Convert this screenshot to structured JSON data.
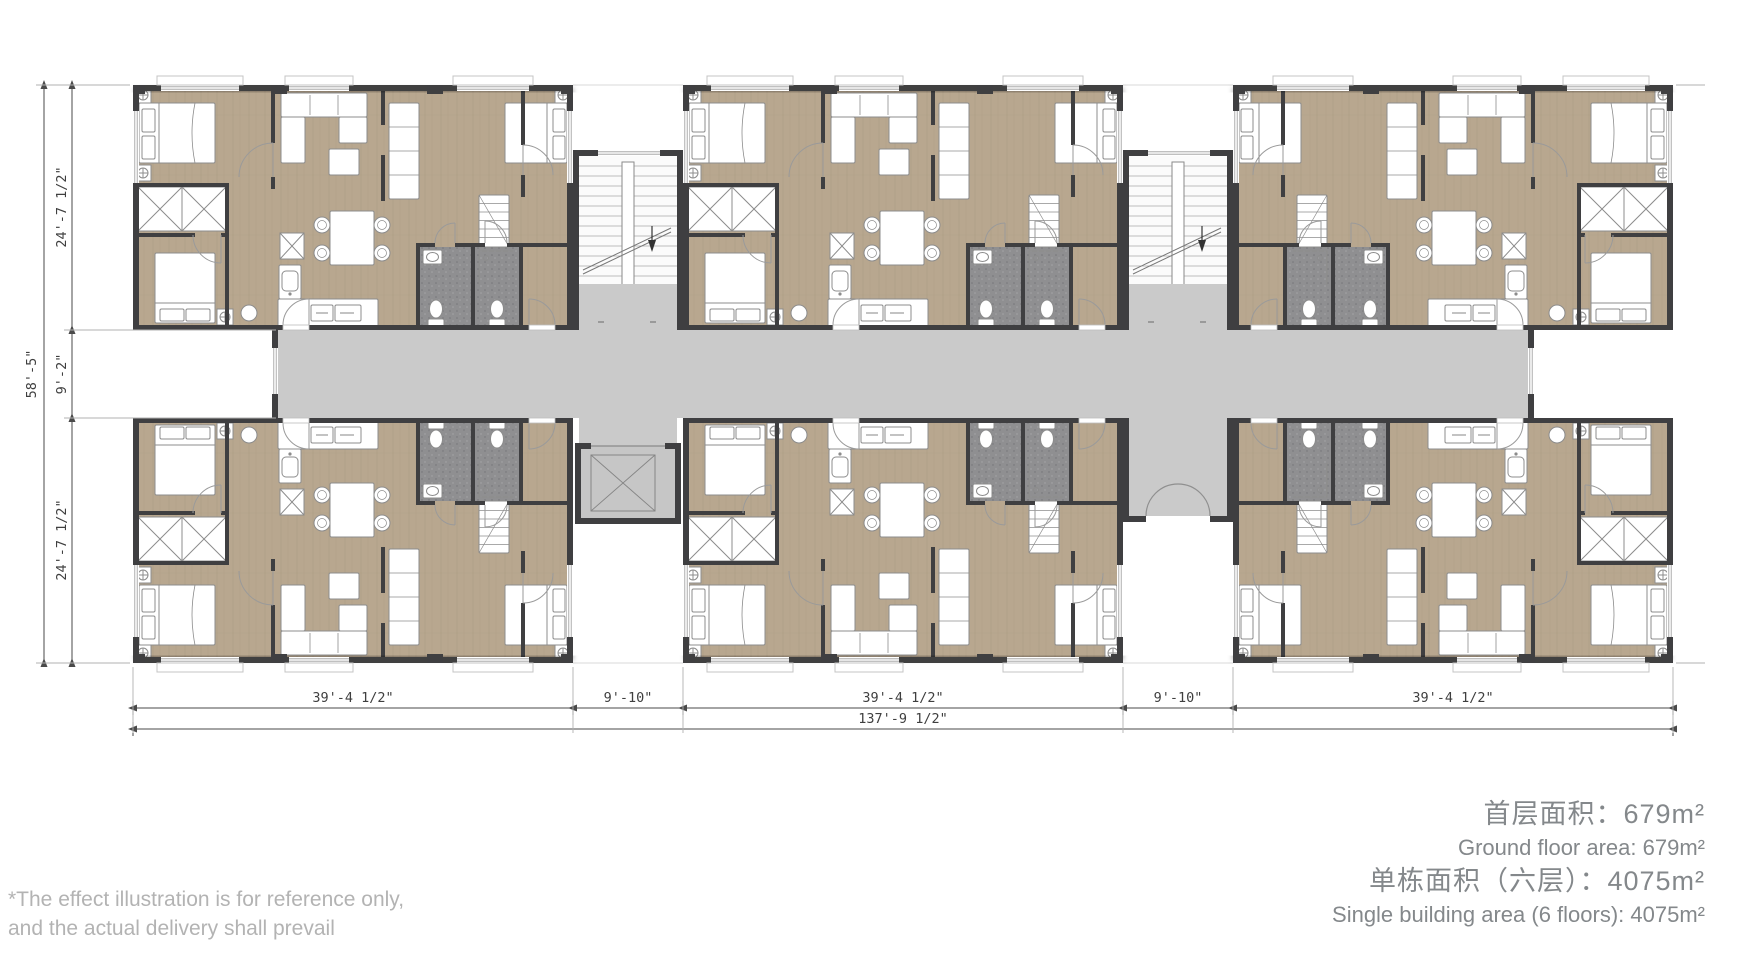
{
  "title": "residential-floor-plan",
  "colors": {
    "wall": "#3f3f41",
    "floor_tan": "#b8a78f",
    "floor_grain": "#9d8c74",
    "corridor_gray": "#cacaca",
    "bathroom_gray": "#8f8f91",
    "furniture_line": "#8c8c8c",
    "dimension_line": "#4a4a4a",
    "extension_line": "#b0b0b0",
    "annotation_gray": "#84888b",
    "disclaimer_gray": "#b3b3b3"
  },
  "dimensions": {
    "left": {
      "overall": "58'-5\"",
      "segments": [
        "24'-7 1/2\"",
        "9'-2\"",
        "24'-7 1/2\""
      ]
    },
    "bottom": {
      "segments": [
        "39'-4 1/2\"",
        "9'-10\"",
        "39'-4 1/2\"",
        "9'-10\"",
        "39'-4 1/2\""
      ],
      "overall": "137'-9 1/2\""
    }
  },
  "area_info": {
    "floor_area_zh": "首层面积：679m²",
    "floor_area_en": "Ground floor area: 679m²",
    "building_area_zh": "单栋面积（六层）：4075m²",
    "building_area_en": "Single building area (6 floors): 4075m²"
  },
  "disclaimer": {
    "line1": "*The effect illustration is for reference only,",
    "line2": "and the actual delivery shall prevail"
  }
}
